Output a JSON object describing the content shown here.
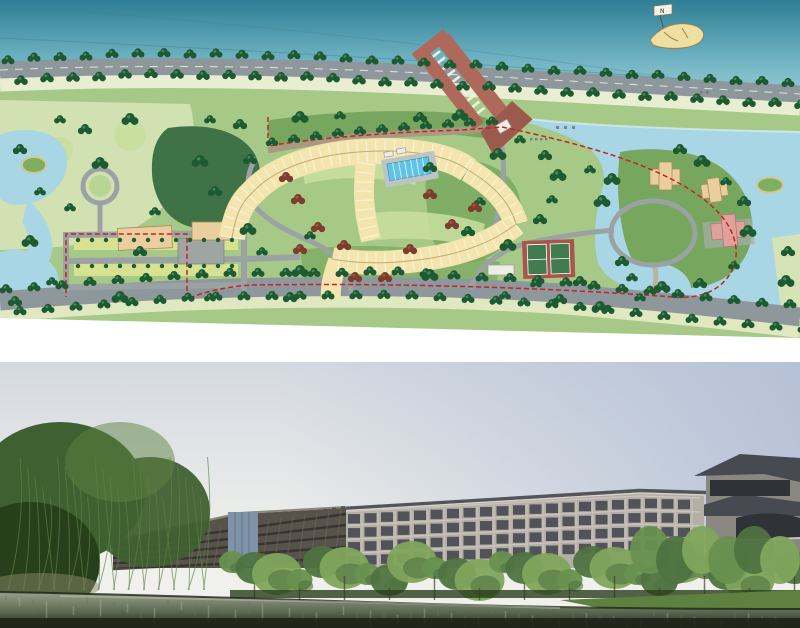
{
  "north_arrow": {
    "label": "N"
  },
  "colors": {
    "page_bg": "#ffffff",
    "plan_water_top": "#2e7d94",
    "plan_water_mid": "#6fb3c2",
    "plan_water_low": "#a7d2d8",
    "plan_contour": "#3d7e8e",
    "plan_road": "#8e979b",
    "plan_road_line": "#f2f2e8",
    "plan_cream": "#e9eed2",
    "plan_pale": "#d6e3b6",
    "plan_pale2": "#dfe8c0",
    "plan_river": "#a9d6e4",
    "plan_river_hl": "#d2ecf2",
    "plan_green": "#a6c987",
    "plan_lawn": "#c8dfa0",
    "plan_lawn2": "#b7d694",
    "plan_forest": "#3f7347",
    "plan_midgreen": "#77a75f",
    "plan_tree": "#1d5a32",
    "plan_tree_hl": "#47935d",
    "plan_tree_red": "#7c3d2c",
    "plan_tree_red_hl": "#a65a3e",
    "plan_hotel": "#f3e5ad",
    "plan_hotel_edge": "#bfab72",
    "plan_pool": "#5ec3e6",
    "plan_deck": "#bcc5c4",
    "plan_pier": "#ae695b",
    "plan_pier_dark": "#9c5a4e",
    "plan_pink": "#dfa29b",
    "plan_pink_edge": "#b4766d",
    "plan_tan": "#eace9e",
    "plan_tan_edge": "#a98d58",
    "plan_gray_bldg": "#9fa5a3",
    "plan_tennis": "#a8564b",
    "plan_tennis_court": "#417c50",
    "plan_boundary": "#c52222",
    "plan_path": "#9aa2a4",
    "plan_drive": "#a79a80",
    "plan_parking": "#d6e292",
    "plan_island": "#7fae5e",
    "plan_boat": "#efe0a2",
    "photo_sky_top": "#aebbd4",
    "photo_sky_low": "#f0f1ec",
    "photo_wall": "#b3afa6",
    "photo_wall_light": "#ccc8bf",
    "photo_win": "#3f434a",
    "photo_dark": "#57534b",
    "photo_dark_win": "#35322d",
    "photo_glass": "#7e93a8",
    "photo_roof": "#53555a",
    "photo_villa_roof": "#474b51",
    "photo_villa_wall": "#8a8780",
    "photo_tree1": "#68904e",
    "photo_tree2": "#4f7340",
    "photo_tree3": "#7fa45c",
    "photo_willow": "#3f6030",
    "photo_willow_dark": "#283f1c",
    "photo_willow_hl": "#5d8243",
    "photo_grass": "#5e813f",
    "photo_water_hi": "#97a08c",
    "photo_water_mid": "#5c6750",
    "photo_water_dark": "#20251a"
  }
}
